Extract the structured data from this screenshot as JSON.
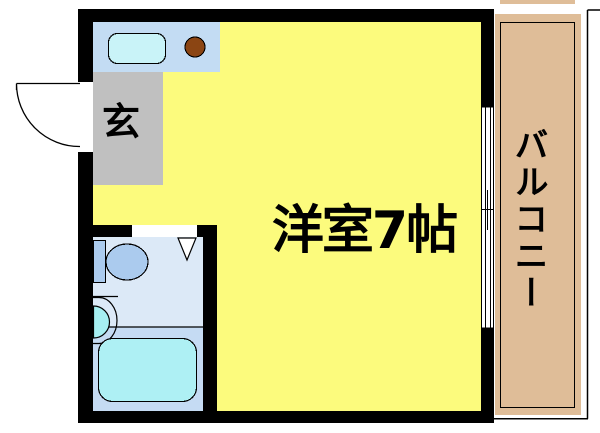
{
  "floorplan": {
    "labels": {
      "main_room": "洋室7帖",
      "entrance": "玄",
      "balcony": "バルコニー"
    },
    "colors": {
      "wall": "#000000",
      "opening": "#ffffff",
      "main_room_floor": "#FCFB7D",
      "entrance_floor": "#C0C0C0",
      "kitchen_counter": "#C3DCF3",
      "kitchen_sink": "#C9F3F8",
      "stove_burner": "#8B4513",
      "bathroom_floor": "#DCE9F7",
      "bath_zone_floor": "#C5DBF3",
      "toilet": "#ABCBEE",
      "wash_basin": "#A6EFF2",
      "bathtub": "#AEF0F4",
      "balcony_floor": "#DFBD98",
      "line": "#000000"
    }
  }
}
